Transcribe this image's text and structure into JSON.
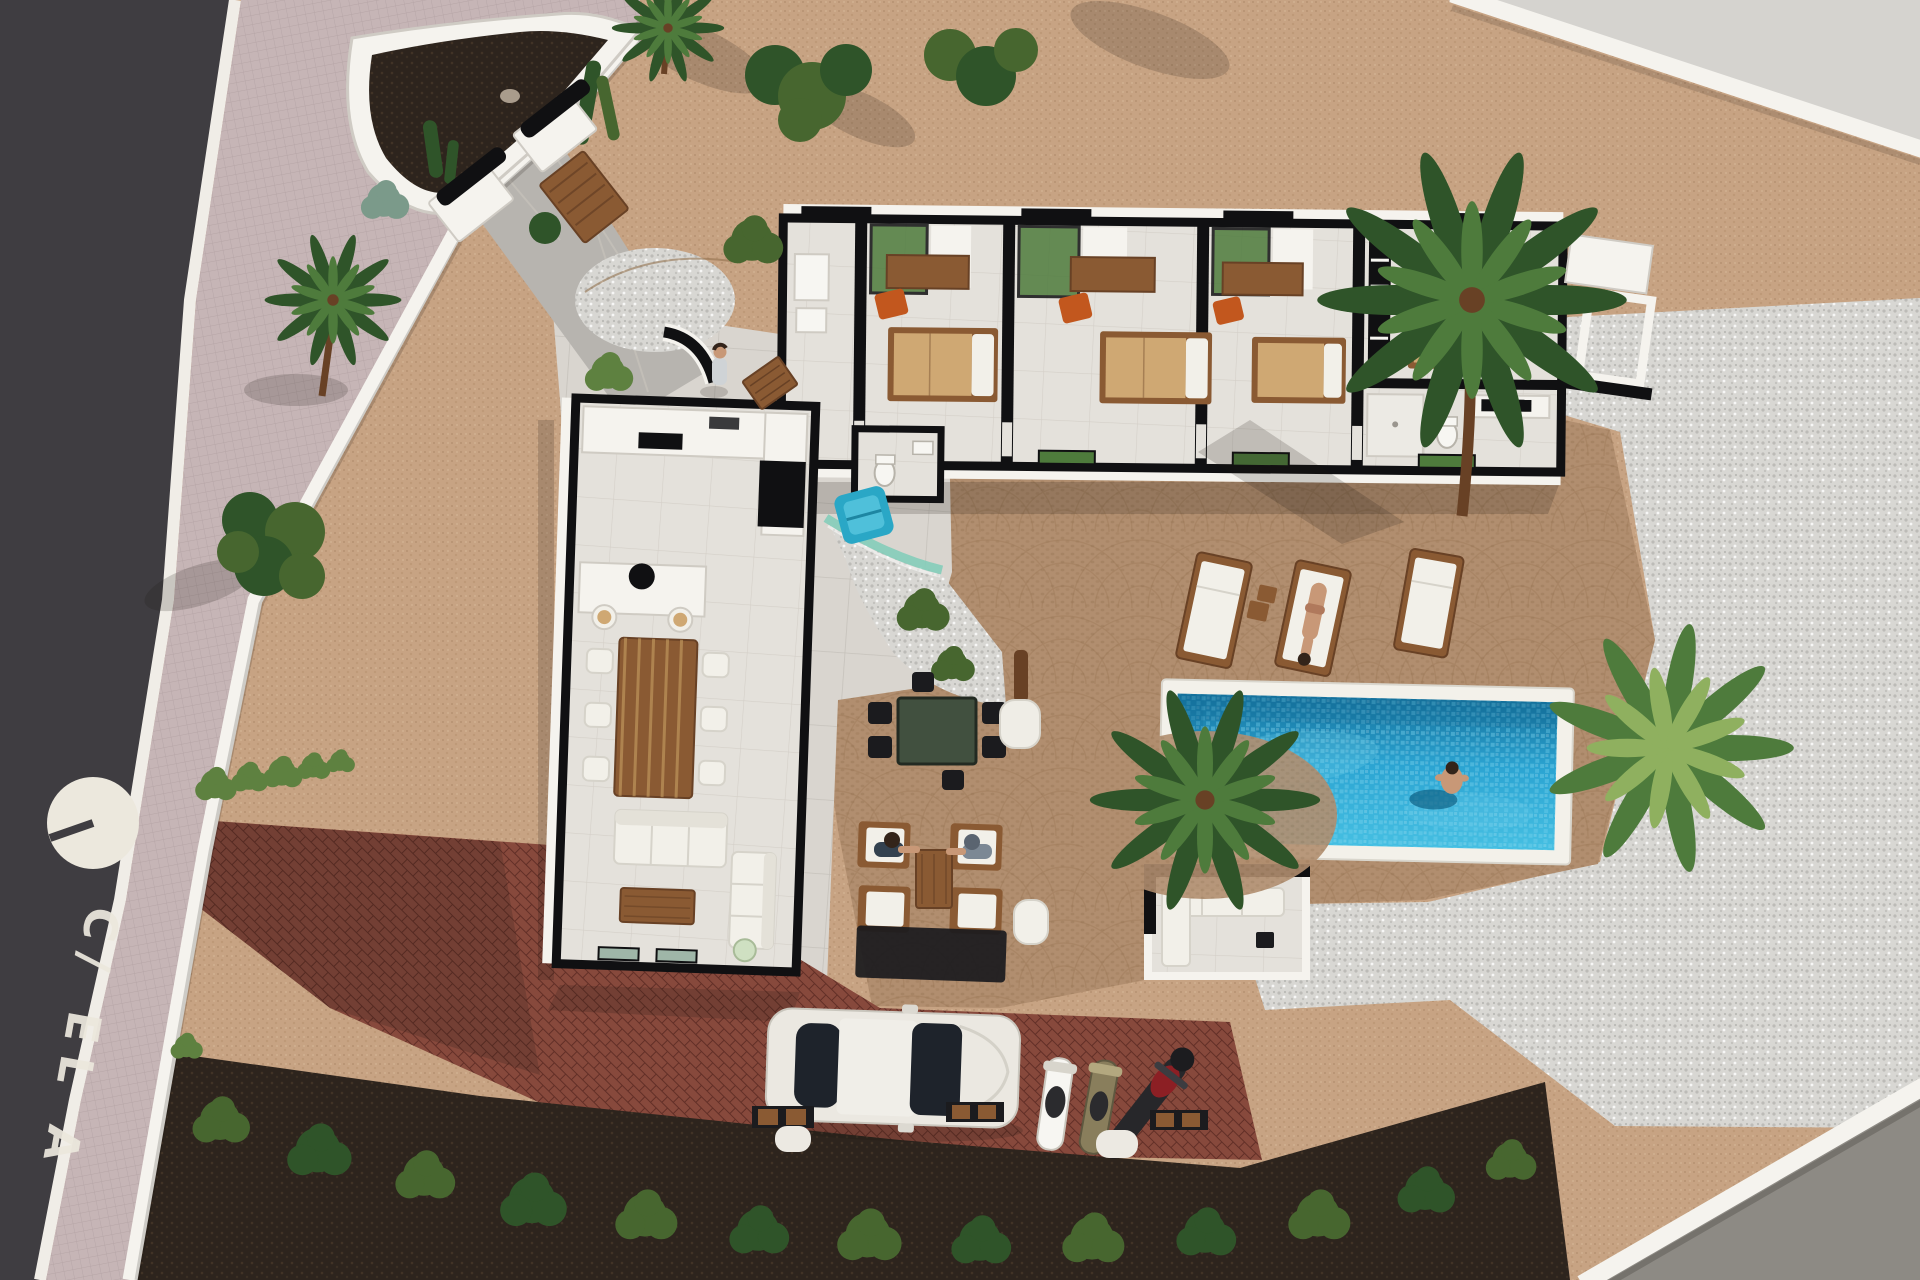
{
  "scene": {
    "kind": "architectural-aerial-3d-render",
    "title": "Aerial 3D render of a single-storey villa plot with pool, terraces, parking and street",
    "people_visible": 5,
    "vehicles_visible": "1 car, 2 scooters, 1 motorcycle"
  },
  "road": {
    "street_label": "C/ EL A",
    "marking": "white circle with dark tick painted on asphalt"
  },
  "colors": {
    "road": "#3f3d41",
    "road_mark": "#ece8dd",
    "sidewalk": "#c6b5b6",
    "sidewalk_line": "#b2a1a3",
    "curb": "#f0ede7",
    "wall": "#f5f3ee",
    "wall_shade": "#cfcbc4",
    "cut": "#101012",
    "gravel": "#c7a383",
    "gravel_dot": "#ab8565",
    "cobble": "#b18e6f",
    "cobble_dot": "#93714f",
    "pebble": "#d8d7d3",
    "pebble_dot": "#b5b4b0",
    "concrete": "#d9d5cf",
    "concrete_line": "#c6c2bb",
    "floor": "#e4e1db",
    "floor_line": "#cfcbc3",
    "brick": "#87493c",
    "brick_dark": "#622f27",
    "soil": "#2d241d",
    "soil_dot": "#4a392a",
    "path": "#b7b4af",
    "pool_border": "#f3f1ea",
    "water": "#2ba4d2",
    "water_dark": "#15719c",
    "water_light": "#7cd4ee",
    "glass": "#84cdb9",
    "wood": "#8a5a33",
    "wood_dark": "#684125",
    "plank": "#c79f63",
    "tan": "#cfa873",
    "cushion": "#f2f0e9",
    "orange": "#c2571e",
    "teal": "#2aa7c6",
    "table_green": "#41503f",
    "dark_furn": "#1b1b1e",
    "palm": "#4e7b3c",
    "palm_dark": "#2f5429",
    "palm_light": "#8fb05f",
    "shrub": "#47662f",
    "hedge": "#5e8140",
    "skin": "#c89877",
    "hair": "#33241a",
    "outside_top": "#d5d3cf",
    "outside_bottom": "#8d8a84",
    "car": "#ebe8e1",
    "car_glass": "#1e232b",
    "moto_red": "#8c1f24",
    "moto_olive": "#897e5c",
    "white": "#f7f6f2"
  }
}
